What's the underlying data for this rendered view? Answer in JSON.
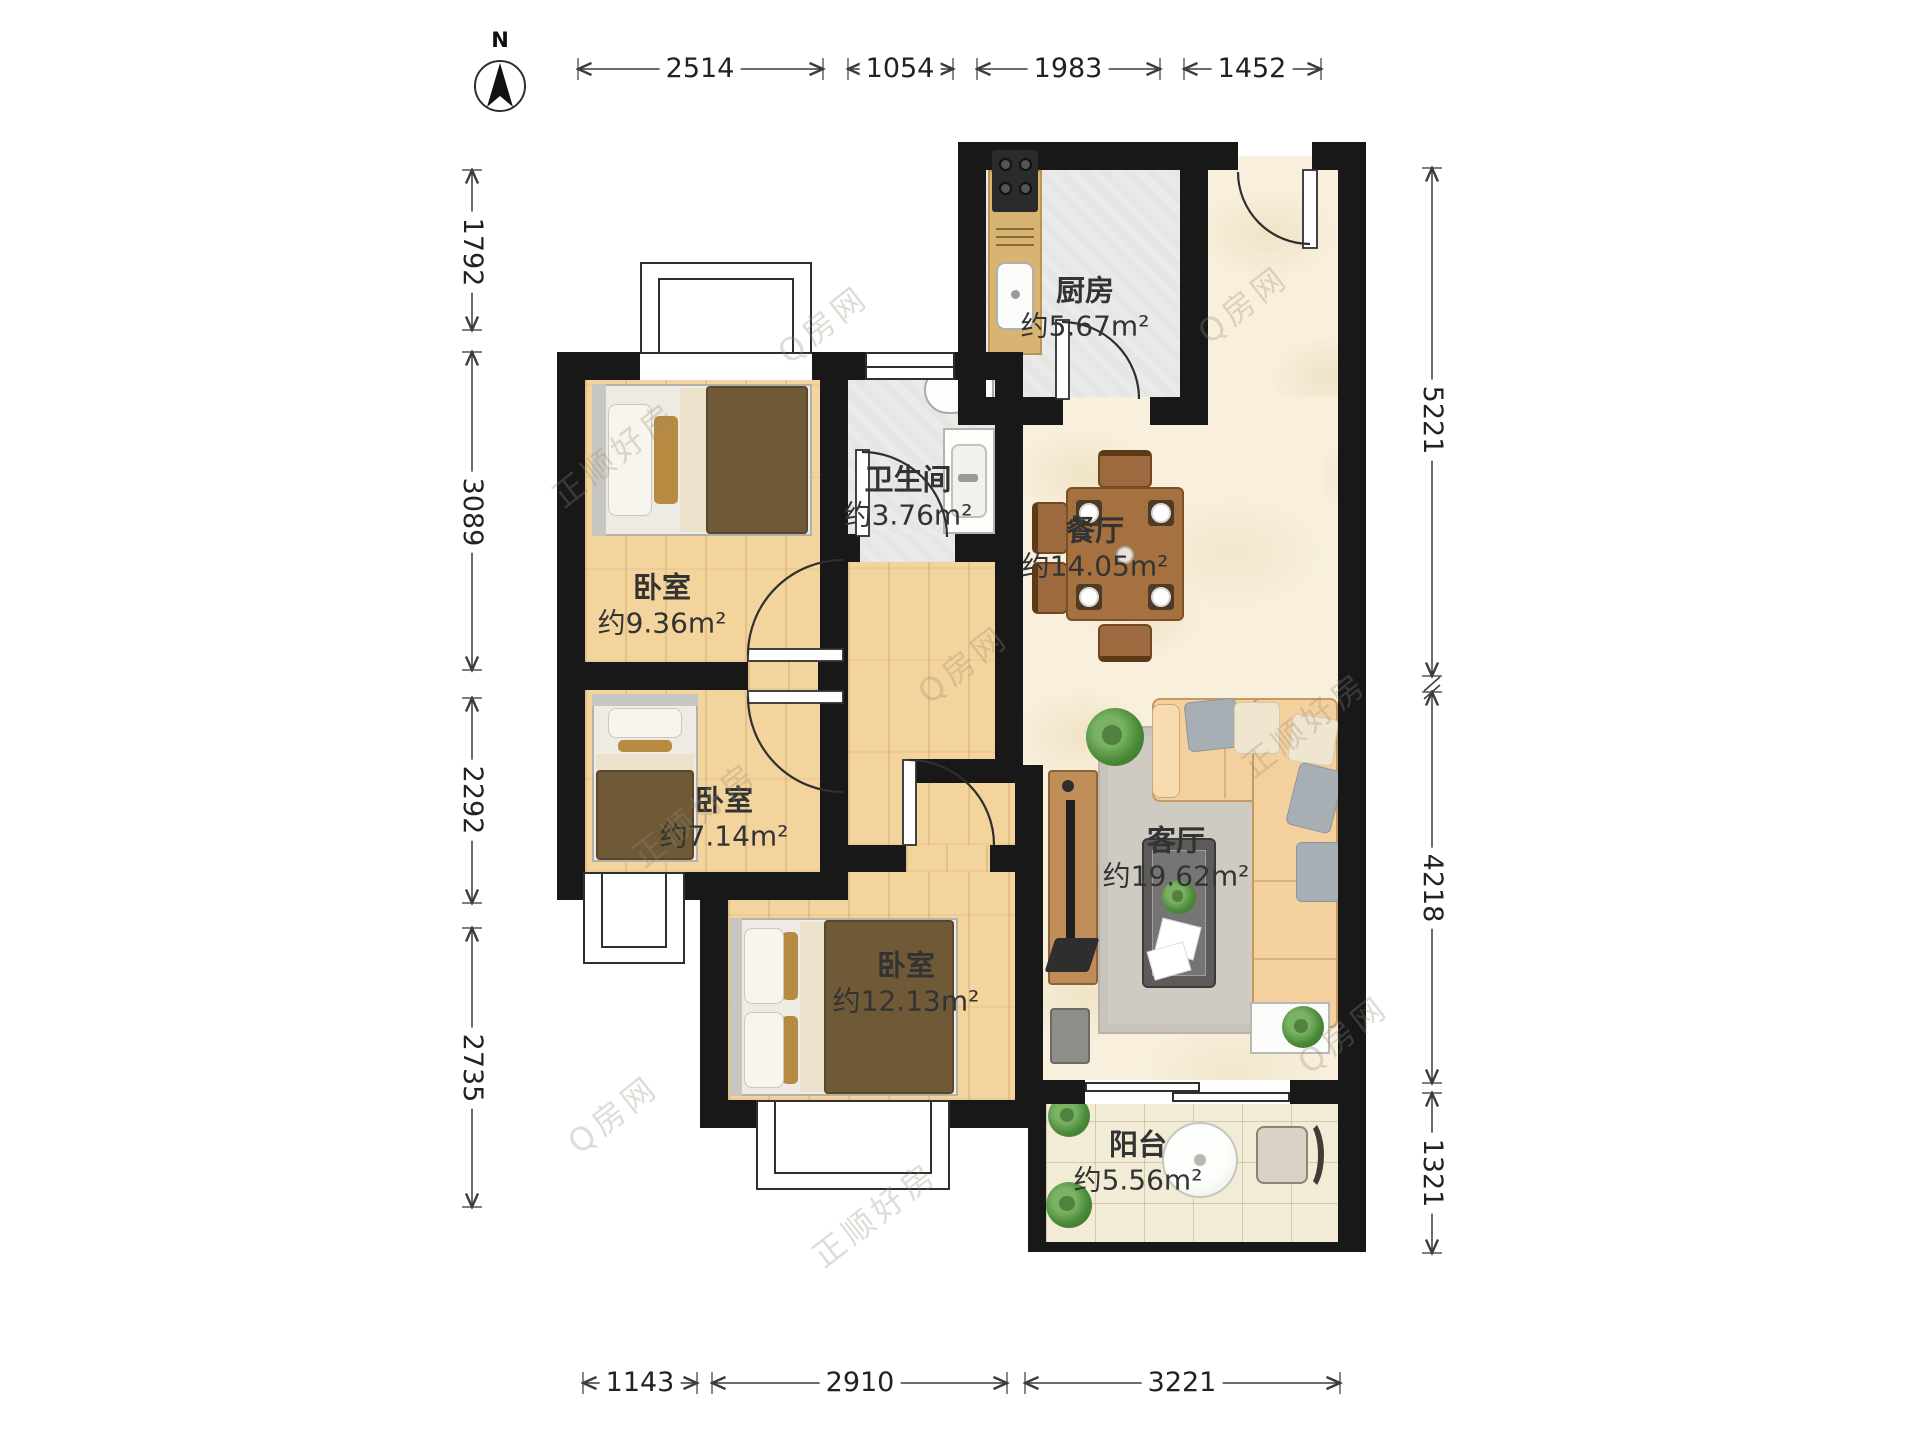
{
  "compass": {
    "label": "N"
  },
  "dimensions": {
    "top": [
      "2514",
      "1054",
      "1983",
      "1452"
    ],
    "left": [
      "1792",
      "3089",
      "2292",
      "2735"
    ],
    "right": [
      "5221",
      "4218",
      "1321"
    ],
    "bottom": [
      "1143",
      "2910",
      "3221"
    ]
  },
  "rooms": {
    "kitchen": {
      "name": "厨房",
      "area": "约5.67m²"
    },
    "bathroom": {
      "name": "卫生间",
      "area": "约3.76m²"
    },
    "dining": {
      "name": "餐厅",
      "area": "约14.05m²"
    },
    "bedroom1": {
      "name": "卧室",
      "area": "约9.36m²"
    },
    "bedroom2": {
      "name": "卧室",
      "area": "约7.14m²"
    },
    "bedroom3": {
      "name": "卧室",
      "area": "约12.13m²"
    },
    "living": {
      "name": "客厅",
      "area": "约19.62m²"
    },
    "balcony": {
      "name": "阳台",
      "area": "约5.56m²"
    }
  },
  "watermarks": {
    "brand": "Q房网",
    "agency": "正顺好房"
  },
  "colors": {
    "wall": "#181818",
    "wood": "#f2d49c",
    "marble": "#f8f0dd",
    "tile": "#eaeae8",
    "blanket": "#6f5936",
    "sofa": "#f4d09f"
  }
}
